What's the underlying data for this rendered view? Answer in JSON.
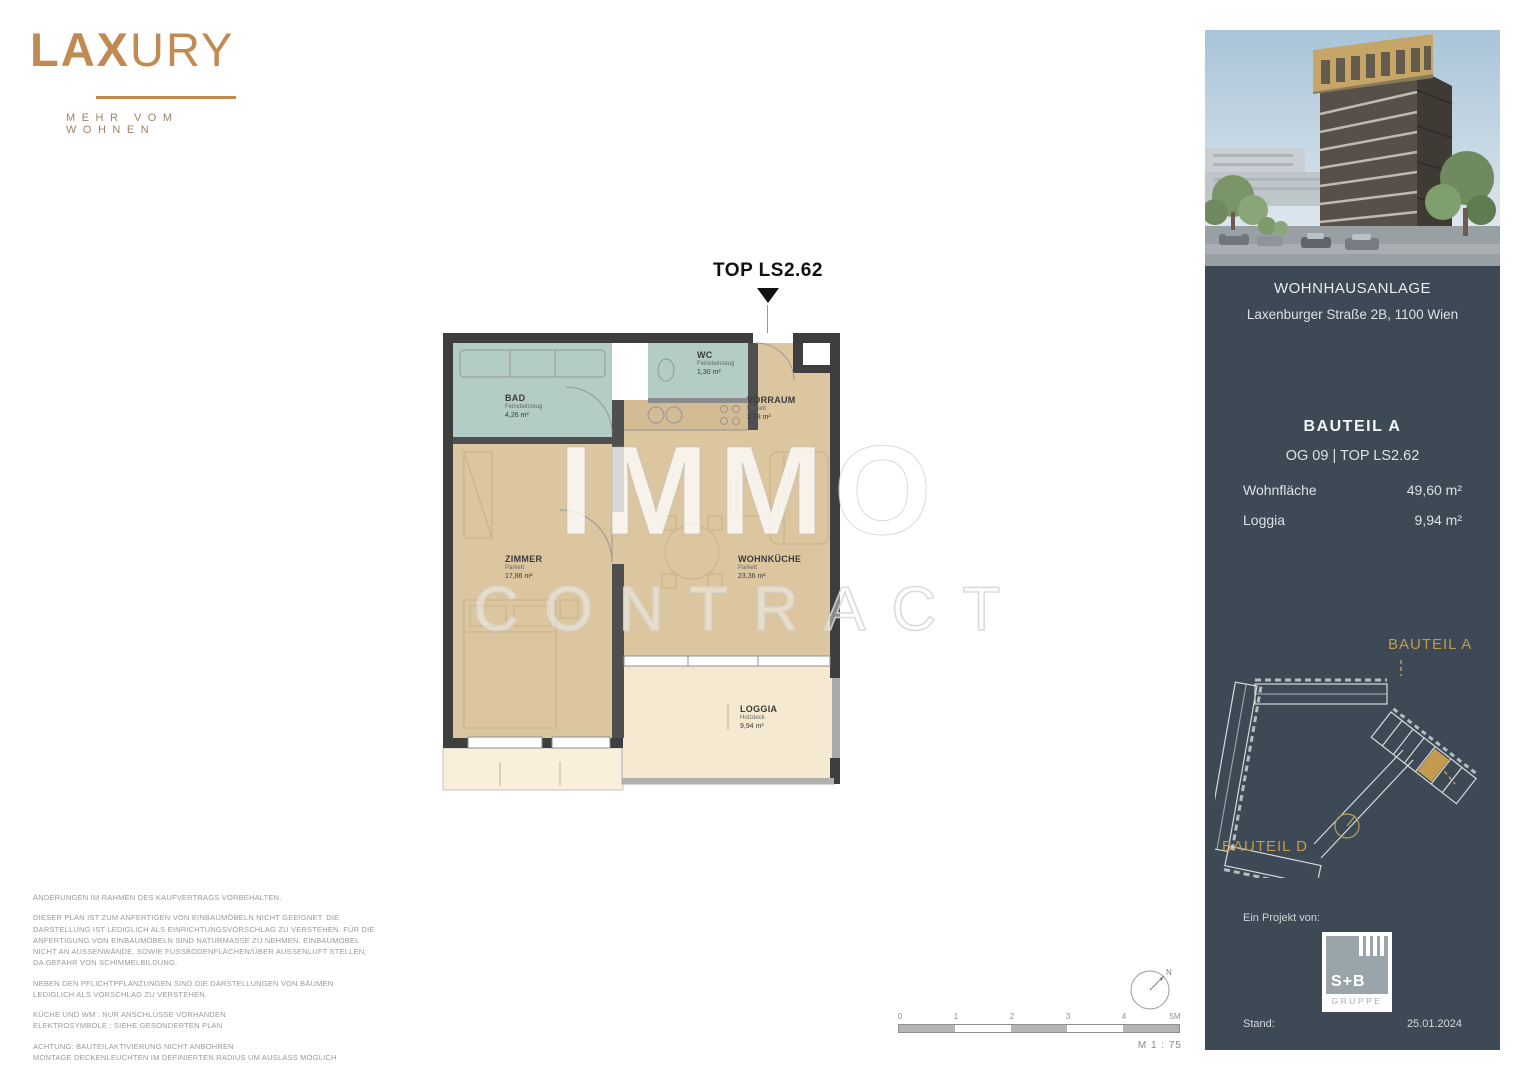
{
  "brand": {
    "name_bold": "LAX",
    "name_light": "URY",
    "tagline": "MEHR VOM WOHNEN",
    "accent_color": "#c08a52"
  },
  "floorplan": {
    "unit_pointer": "TOP LS2.62",
    "rooms": [
      {
        "name": "BAD",
        "material": "Feinsteinzeug",
        "area": "4,26 m²"
      },
      {
        "name": "WC",
        "material": "Feinsteinzeug",
        "area": "1,30 m²"
      },
      {
        "name": "VORRAUM",
        "material": "Parkett",
        "area": "2,78 m²"
      },
      {
        "name": "ZIMMER",
        "material": "Parkett",
        "area": "17,86 m²"
      },
      {
        "name": "WOHNKÜCHE",
        "material": "Parkett",
        "area": "23,36 m²"
      },
      {
        "name": "LOGGIA",
        "material": "Holzdeck",
        "area": "9,94 m²"
      }
    ],
    "scale_ticks": [
      "0",
      "1",
      "2",
      "3",
      "4",
      "5M"
    ],
    "scale_label": "M 1 : 75",
    "north_label": "N",
    "colors": {
      "wall": "#3e3e3e",
      "room_beige": "#dcc6a0",
      "wet_teal": "#b3ccc5",
      "loggia_cream": "#f5ead1"
    }
  },
  "watermark": {
    "line1": "IMMO",
    "line2": "CONTRACT"
  },
  "disclaimer": {
    "p1": "ÄNDERUNGEN IM RAHMEN DES KAUFVERTRAGS VORBEHALTEN.",
    "p2": "DIESER PLAN IST ZUM ANFERTIGEN VON EINBAUMÖBELN NICHT GEEIGNET. DIE DARSTELLUNG IST LEDIGLICH ALS EINRICHTUNGSVORSCHLAG ZU VERSTEHEN. FÜR DIE ANFERTIGUNG VON EINBAUMÖBELN SIND NATURMASSE ZU NEHMEN. EINBAUMÖBEL NICHT AN AUSSENWÄNDE, SOWIE FUSSBODENFLÄCHEN/ÜBER AUSSENLUFT STELLEN, DA GEFAHR VON SCHIMMELBILDUNG.",
    "p3": "NEBEN DEN PFLICHTPFLANZUNGEN SIND DIE DARSTELLUNGEN VON BÄUMEN\nLEDIGLICH ALS VORSCHLAG ZU VERSTEHEN.",
    "p4": "KÜCHE UND WM : NUR ANSCHLÜSSE VORHANDEN\nELEKTROSYMBOLE : SIEHE GESONDERTEN PLAN",
    "p5": "ACHTUNG: BAUTEILAKTIVIERUNG NICHT ANBOHREN\nMONTAGE DECKENLEUCHTEN IM DEFINIERTEN RADIUS UM AUSLASS MÖGLICH"
  },
  "sidebar": {
    "bg_color": "#3d4954",
    "project_title": "WOHNHAUSANLAGE",
    "project_address": "Laxenburger Straße 2B, 1100 Wien",
    "bauteil": "BAUTEIL A",
    "floor_unit": "OG 09 | TOP LS2.62",
    "area_rows": [
      {
        "label": "Wohnfläche",
        "value": "49,60 m²"
      },
      {
        "label": "Loggia",
        "value": "9,94 m²"
      }
    ],
    "siteplan": {
      "label_a": "BAUTEIL A",
      "label_d": "BAUTEIL D",
      "highlight_color": "#c49a4e"
    },
    "project_by_label": "Ein Projekt von:",
    "developer": {
      "logo_top": "S+B",
      "logo_bottom": "GRUPPE"
    },
    "stand_label": "Stand:",
    "stand_date": "25.01.2024"
  }
}
